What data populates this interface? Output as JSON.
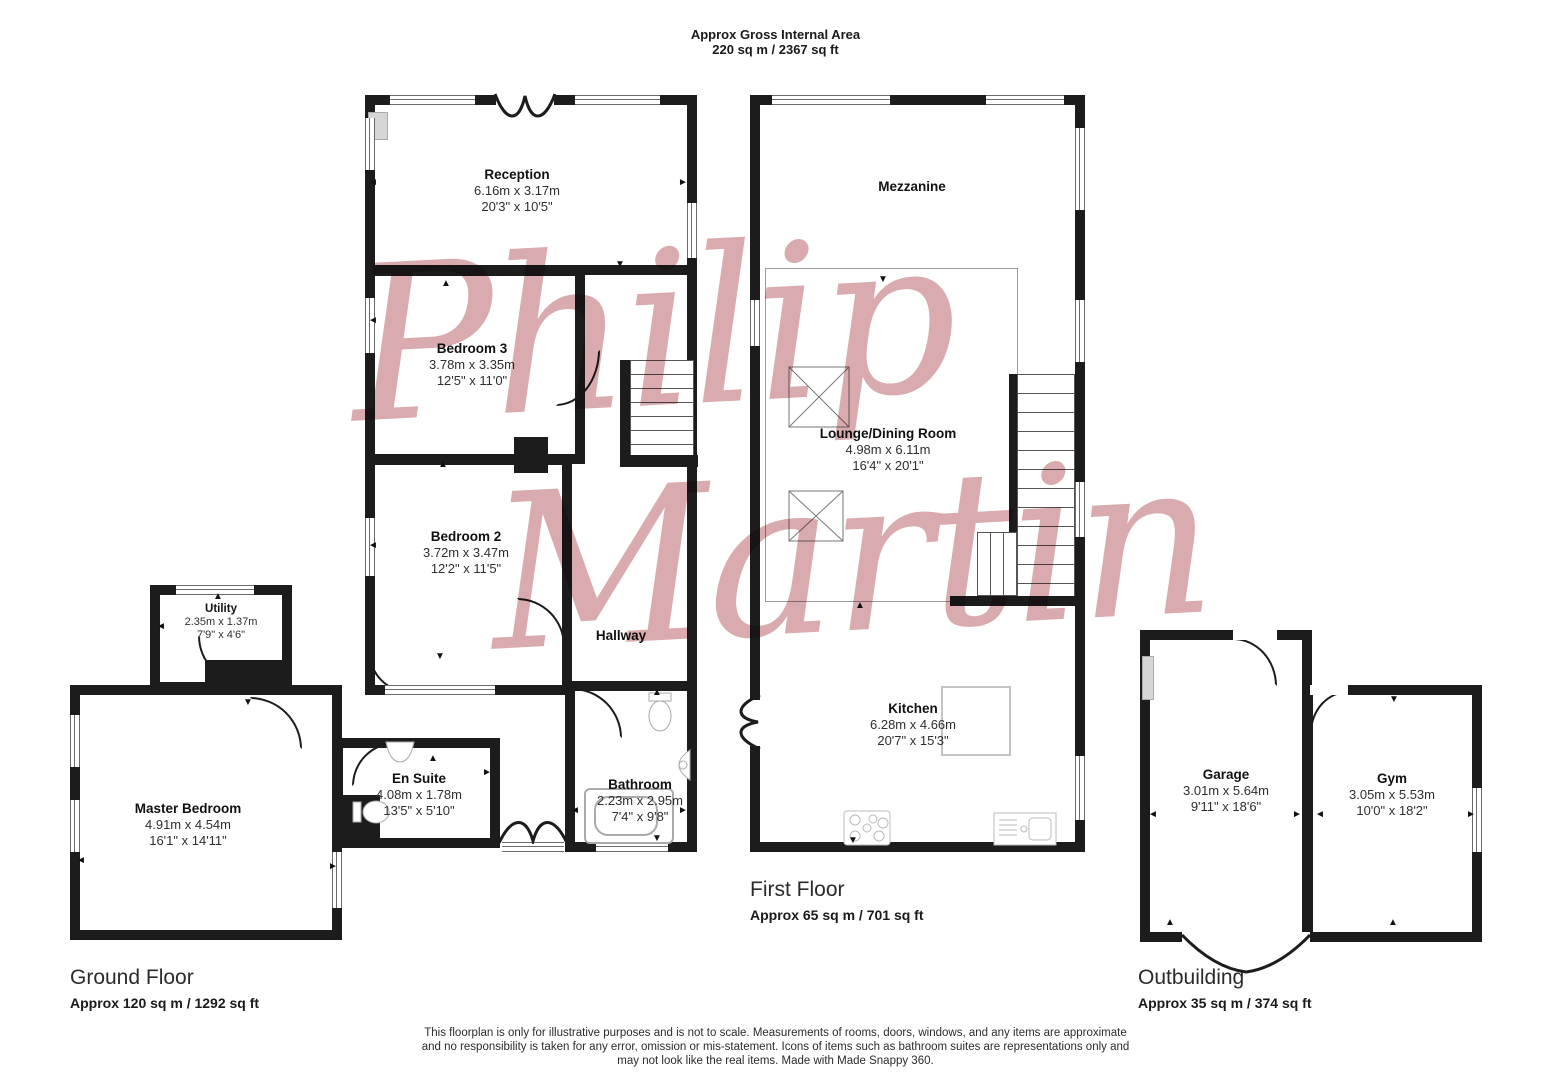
{
  "title": {
    "heading": "Approx Gross Internal Area",
    "area": "220 sq m / 2367 sq ft"
  },
  "watermark": {
    "word1": "Philip",
    "word2": "Martin"
  },
  "colors": {
    "wall": "#1c1c1c",
    "watermark_pink": "#d9abae",
    "fixture_gray": "#b5b5b5"
  },
  "floors": {
    "ground": {
      "label": "Ground Floor",
      "area": "Approx 120 sq m / 1292 sq ft"
    },
    "first": {
      "label": "First Floor",
      "area": "Approx 65 sq m / 701 sq ft"
    },
    "outbuilding": {
      "label": "Outbuilding",
      "area": "Approx 35 sq m / 374 sq ft"
    }
  },
  "rooms": {
    "reception": {
      "name": "Reception",
      "metric": "6.16m x 3.17m",
      "imperial": "20'3\" x 10'5\""
    },
    "bedroom3": {
      "name": "Bedroom 3",
      "metric": "3.78m x 3.35m",
      "imperial": "12'5\" x 11'0\""
    },
    "bedroom2": {
      "name": "Bedroom 2",
      "metric": "3.72m x 3.47m",
      "imperial": "12'2\" x 11'5\""
    },
    "hallway": {
      "name": "Hallway"
    },
    "utility": {
      "name": "Utility",
      "metric": "2.35m x 1.37m",
      "imperial": "7'9\" x 4'6\""
    },
    "master": {
      "name": "Master Bedroom",
      "metric": "4.91m x 4.54m",
      "imperial": "16'1\" x 14'11\""
    },
    "ensuite": {
      "name": "En Suite",
      "metric": "4.08m x 1.78m",
      "imperial": "13'5\" x 5'10\""
    },
    "bathroom": {
      "name": "Bathroom",
      "metric": "2.23m x 2.95m",
      "imperial": "7'4\" x 9'8\""
    },
    "mezzanine": {
      "name": "Mezzanine"
    },
    "lounge": {
      "name": "Lounge/Dining Room",
      "metric": "4.98m x 6.11m",
      "imperial": "16'4\" x 20'1\""
    },
    "kitchen": {
      "name": "Kitchen",
      "metric": "6.28m x 4.66m",
      "imperial": "20'7\" x 15'3\""
    },
    "garage": {
      "name": "Garage",
      "metric": "3.01m x 5.64m",
      "imperial": "9'11\" x 18'6\""
    },
    "gym": {
      "name": "Gym",
      "metric": "3.05m x 5.53m",
      "imperial": "10'0\" x 18'2\""
    }
  },
  "footer": {
    "line1": "This floorplan is only for illustrative purposes and is not to scale. Measurements of rooms, doors, windows, and any items are approximate",
    "line2": "and no responsibility is taken for any error, omission or mis-statement. Icons of items such as bathroom suites are representations only and",
    "line3": "may not look like the real items. Made with Made Snappy 360."
  }
}
